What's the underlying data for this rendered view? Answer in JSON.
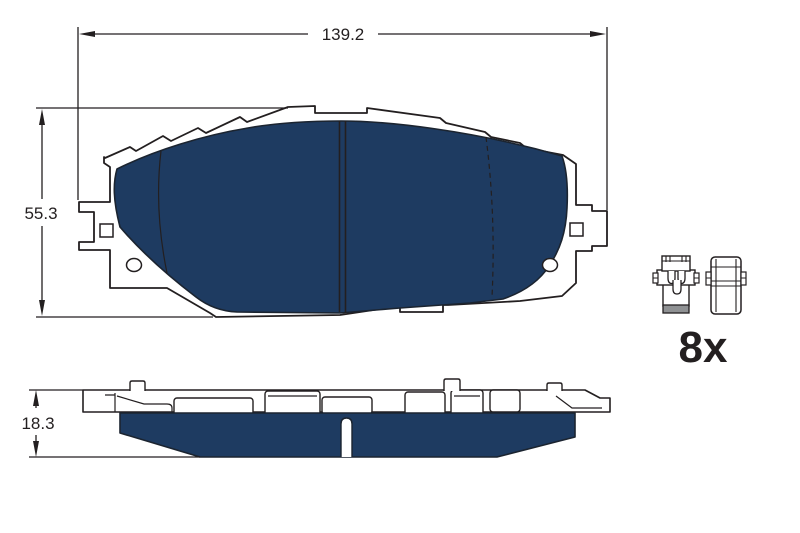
{
  "dimensions": {
    "width": "139.2",
    "height": "55.3",
    "thickness": "18.3"
  },
  "accessory": {
    "quantity": "8x"
  },
  "colors": {
    "friction_material": "#1e3b61",
    "outline": "#231f20",
    "clip_band_gray": "#8f9193",
    "background": "#ffffff"
  },
  "icons": {
    "front_view": "brake-pad-front-view",
    "side_view": "brake-pad-top-view",
    "clip_left": "pad-retainer-clip-icon",
    "clip_right": "shim-clip-icon"
  }
}
